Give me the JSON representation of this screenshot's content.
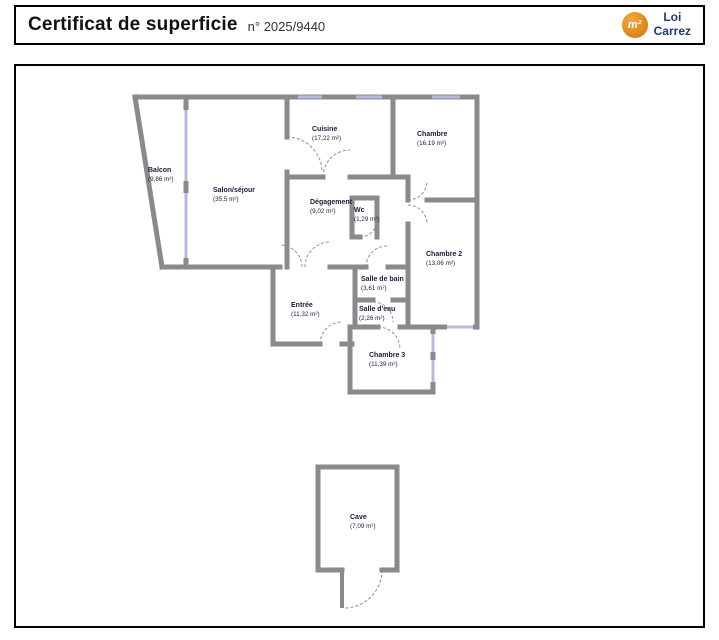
{
  "header": {
    "title": "Certificat de superficie",
    "number": "n° 2025/9440",
    "logo": {
      "badge": "m²",
      "label_line1": "Loi",
      "label_line2": "Carrez",
      "badge_color": "#e08a1e",
      "text_color": "#1f3a6e"
    }
  },
  "colors": {
    "wall_gray": "#8a8a8a",
    "window_blue": "#b4badf",
    "door_arc_gray": "#8f8f8f",
    "label_navy": "#1b1b3a"
  },
  "rooms": [
    {
      "name": "Balcon",
      "area": "(9,86 m²)"
    },
    {
      "name": "Salon/séjour",
      "area": "(35,5 m²)"
    },
    {
      "name": "Cuisine",
      "area": "(17,22 m²)"
    },
    {
      "name": "Chambre",
      "area": "(16,19 m²)"
    },
    {
      "name": "Dégagement",
      "area": "(9,02 m²)"
    },
    {
      "name": "Wc",
      "area": "(1,29 m²)"
    },
    {
      "name": "Chambre 2",
      "area": "(13,06 m²)"
    },
    {
      "name": "Salle de bain",
      "area": "(3,61 m²)"
    },
    {
      "name": "Salle d'eau",
      "area": "(2,26 m²)"
    },
    {
      "name": "Entrée",
      "area": "(11,32 m²)"
    },
    {
      "name": "Chambre 3",
      "area": "(11,39 m²)"
    },
    {
      "name": "Cave",
      "area": "(7,09 m²)"
    }
  ]
}
